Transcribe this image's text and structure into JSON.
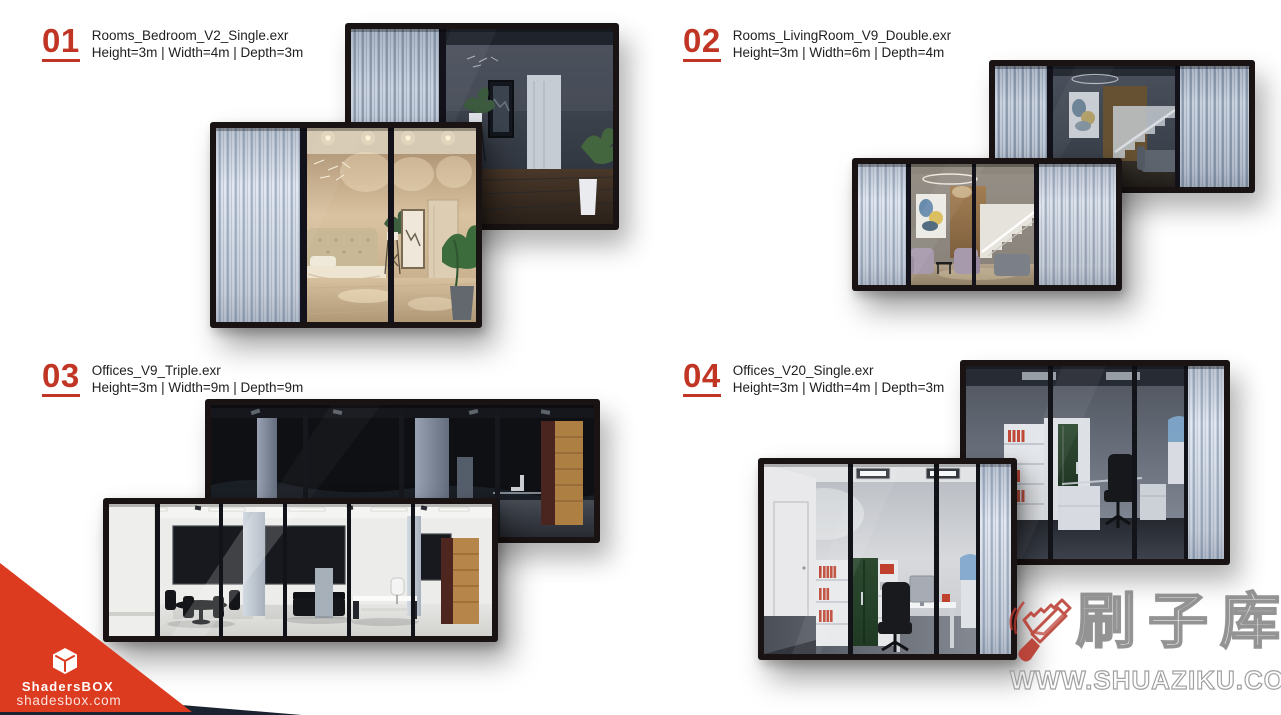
{
  "page": {
    "width": 1281,
    "height": 715
  },
  "entries": [
    {
      "number": "01",
      "filename": "Rooms_Bedroom_V2_Single.exr",
      "dimensions": "Height=3m | Width=4m | Depth=3m"
    },
    {
      "number": "02",
      "filename": "Rooms_LivingRoom_V9_Double.exr",
      "dimensions": "Height=3m | Width=6m | Depth=4m"
    },
    {
      "number": "03",
      "filename": "Offices_V9_Triple.exr",
      "dimensions": "Height=3m | Width=9m | Depth=9m"
    },
    {
      "number": "04",
      "filename": "Offices_V20_Single.exr",
      "dimensions": "Height=3m | Width=4m | Depth=3m"
    }
  ],
  "branding": {
    "name_prefix": "Shaders",
    "name_suffix": "BOX",
    "website": "shadesbox.com",
    "triangle_red": "#dd3b20",
    "triangle_navy": "#1c2330"
  },
  "watermark": {
    "brand": "刷子库",
    "url": "WWW.SHUAZIKU.COM",
    "accent": "#b8372b"
  },
  "colors": {
    "entry_number_red": "#c13524",
    "text_dark": "#1e1e1e"
  }
}
